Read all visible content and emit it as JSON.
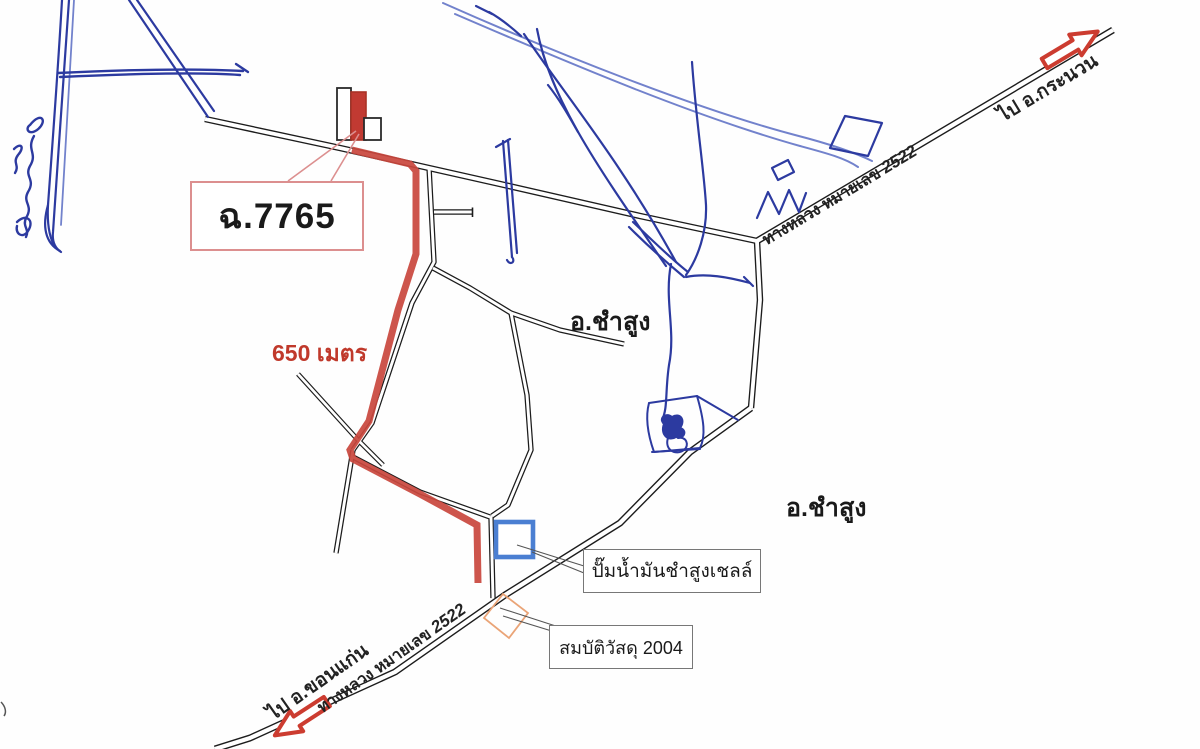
{
  "document": {
    "type": "hand-annotated road sketch map",
    "labels": {
      "parcel": "ฉ.7765",
      "distance": "650 เมตร",
      "district_1": "อ.ชำสูง",
      "district_2": "อ.ชำสูง",
      "gas_station": "ปั๊มน้ำมันชำสูงเชลล์",
      "material_shop": "สมบัติวัสดุ 2004"
    },
    "highway_ne": {
      "name": "ทางหลวง หมายเลข",
      "number": "2522",
      "direction": "ไป อ.กระนวน"
    },
    "highway_sw": {
      "name": "ทางหลวง หมายเลข",
      "number": "2522",
      "direction": "ไป อ.ขอนแก่น"
    },
    "colors": {
      "route_red": "#c9473d",
      "building_red": "#c13a32",
      "road_black": "#1c1c1c",
      "ink_blue": "#2c3aa0",
      "ink_blue_light": "#7282cc",
      "marker_blue": "#4b7fd2",
      "marker_orange": "#eaa477",
      "callout_pink": "#dc8f8f"
    }
  }
}
